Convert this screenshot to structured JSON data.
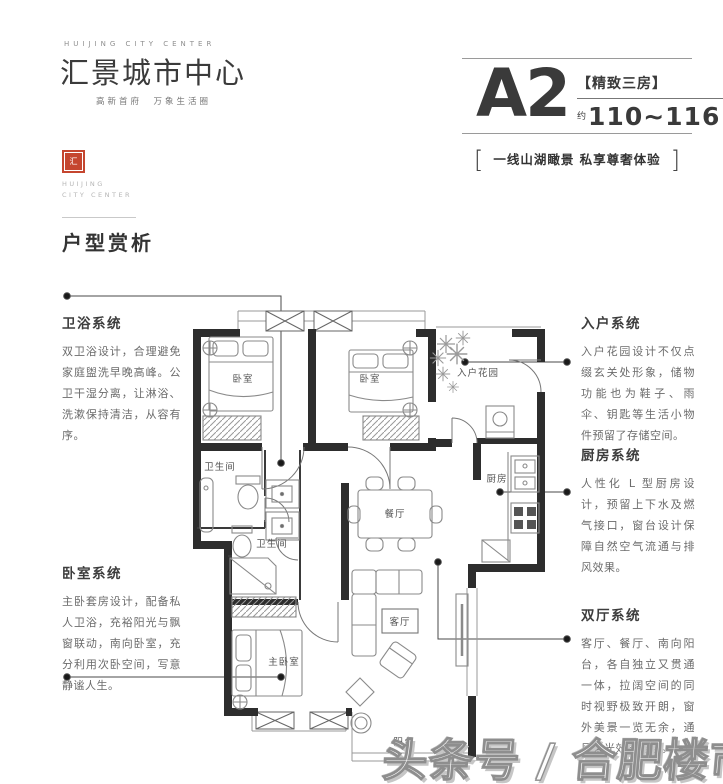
{
  "brand": {
    "logo_en": "HUIJING CITY CENTER",
    "logo_cn": "汇景城市中心",
    "logo_tagline": "高新首府　万象生活圈",
    "seal_text": "汇",
    "seal_en_line1": "HUIJING",
    "seal_en_line2": "CITY CENTER"
  },
  "unit": {
    "name": "A2",
    "tag": "【精致三房】",
    "approx": "约",
    "area": "110~116",
    "area_unit": "m²",
    "slogan": "一线山湖瞰景  私享尊奢体验"
  },
  "section": {
    "title": "户型赏析"
  },
  "annotations": [
    {
      "id": "bath",
      "title": "卫浴系统",
      "body": "双卫浴设计，合理避免家庭盥洗早晚高峰。公卫干湿分离，让淋浴、洗漱保持清洁，从容有序。"
    },
    {
      "id": "bedroom",
      "title": "卧室系统",
      "body": "主卧套房设计，配备私人卫浴，充裕阳光与飘窗联动，南向卧室，充分利用次卧空间，写意静谧人生。"
    },
    {
      "id": "entry",
      "title": "入户系统",
      "body": "入户花园设计不仅点缀玄关处形象，储物功能也为鞋子、雨伞、钥匙等生活小物件预留了存储空间。"
    },
    {
      "id": "kitchen",
      "title": "厨房系统",
      "body": "人性化 L 型厨房设计，预留上下水及燃气接口，窗台设计保障自然空气流通与排风效果。"
    },
    {
      "id": "living",
      "title": "双厅系统",
      "body": "客厅、餐厅、南向阳台，各自独立又贯通一体，拉阔空间的同时视野极致开朗，窗外美景一览无余，通风采光效果更佳。"
    }
  ],
  "floorplan": {
    "rooms": {
      "bedroom1": "卧室",
      "bedroom2": "卧室",
      "entry_garden": "入户花园",
      "bath1": "卫生间",
      "bath2": "卫生间",
      "dining": "餐厅",
      "kitchen": "厨房",
      "living": "客厅",
      "master": "主卧室",
      "balcony": "阳台"
    }
  },
  "watermark": "头条号 / 合肥楼市点评",
  "colors": {
    "accent_red": "#c5462f",
    "ink": "#3a3a3a",
    "wall": "#2d2d2d",
    "muted": "#8a8a8a"
  }
}
